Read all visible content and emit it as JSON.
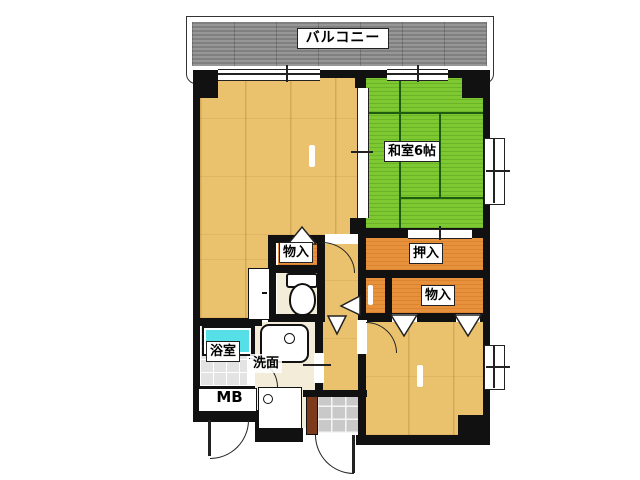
{
  "floor_plan": {
    "balcony": {
      "label": "バルコニー"
    },
    "rooms": {
      "washitsu": {
        "label": "和室6帖"
      },
      "oshiire": {
        "label": "押入"
      },
      "monoire_upper": {
        "label": "物入"
      },
      "monoire_lower": {
        "label": "物入"
      },
      "bathroom": {
        "label": "浴室"
      },
      "washroom": {
        "label": "洗面"
      },
      "meter_box": {
        "label": "MB"
      }
    },
    "colors": {
      "wood_floor": "#EAC26E",
      "tatami": "#7EC931",
      "closet": "#E8913C",
      "balcony": "#8F8F8F",
      "wall": "#111111",
      "bathtub": "#57DFE8",
      "bath_tile": "#E3E3E3",
      "entrance_tile": "#C9C9C9",
      "vinyl_floor": "#F2ECD9",
      "shoe_cabinet": "#7C3B1C"
    }
  }
}
